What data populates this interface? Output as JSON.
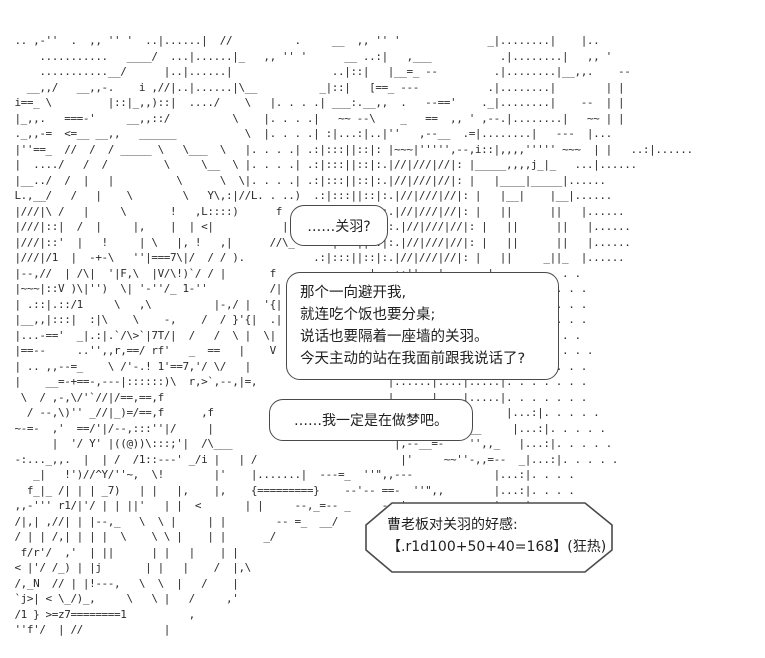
{
  "scene": {
    "background_color": "#ffffff",
    "ink_color": "#2b2b2b",
    "outline_color": "#4a4a4a"
  },
  "bubbles": {
    "guanyu": {
      "text": "……关羽?"
    },
    "monologue": {
      "lines": [
        "那个一向避开我,",
        "就连吃个饭也要分桌;",
        "说话也要隔着一座墙的关羽。",
        "今天主动的站在我面前跟我说话了?"
      ]
    },
    "dream": {
      "text": "……我一定是在做梦吧。"
    },
    "dice": {
      "lines": [
        "曹老板对关羽的好感:",
        "【.r1d100+50+40=168】(狂热)"
      ]
    }
  },
  "ascii_art": {
    "lines": [
      "",
      "",
      "  .. ,-''  .  ,, '' '  ..|......|  //          .     __  ,, '' '              _|........|    |..",
      "      ...........   ____/  ...|......|_   ,, '' '      __ ..:|   ,___           .|........|   ,, '",
      "      ...........__/      |..|......|                ..|::|   |__=_ --         .|........|__,,.    --",
      "    __,,/   __,,-.    i ,//|..|......|\\__          _|::|   [==_ ---           .|........|        | |",
      "  i==_ \\         |::|_,,)::|  ..../    \\   |. . . .| ___:.__,,  .   --=='    ._|........|    --  | |",
      "  |_,,.   ===-'     __,,::/          \\    |. . . .|   ~~ --\\    _   ==  ,, ' ,--.|........|   ~~ | |",
      "  ._,,-=  <=__ __,,   ______           \\  |. . . .| :|...:|..|''   ,--__  .=|........|   ---  |...",
      "  |''==_  //  /  / _____ \\   \\___  \\   |. . . .| .:|:::||::|: |~~~|''''',--,i::|,,,,''''' ~~~  | |   ..:|......",
      "  |  ..../   /  /         \\     \\__  \\ |. . . .| .:|:::||::|:.|//|///|//|: |_____,,,,j_|_   ...|......",
      "  |__../  /  |   |          \\      \\  \\|. . . .| .:|:::||::|:.|//|///|//|: |   |____|_____|......",
      "  L.,__/   /   |    \\        \\   Y\\,:|//L. . ..)  .:|:::||::|:.|//|///|//|: |   |__|    |__|......",
      "  |///|\\ /   |     \\       !   ,L::::)      f     .:|:::||::|:.|//|///|//|: |   ||      ||   |......",
      "  |///|::|  /  |     |,    |  | <|           |     .:|:::||::|:.|//|///|//|: |   ||      ||   |......",
      "  |///|::'  |   !     | \\   |, !   ,|      //\\_    .:|:::||::|:.|//|///|//|: |   ||      ||   |......",
      "  |///|/1  |  -+-\\   ''|===7\\|/  / / ).           .:|:::||::|:.|//|///|//|: |   ||     _||_  |......",
      "  |--,//  | /\\|  '|F,\\  |V/\\!)`/ / |       f               |   ::||   |       |   . . . . . .",
      "  |~~~|::V )\\|'')  \\| '-''/_ 1-''          /|               |   ::||   |       |   . . . . . .",
      "  | .::|.::/1     \\   ,\\          |-,/ |  '{|               |   ::||   |       |   . . . . . .",
      "  |__,,|:::|  :|\\    \\    -,    /  / }'{|  .|               |   ::||   |       |   . . . . . .",
      "  |...-=='  _|.:|.`/\\>`|7T/|  /   /  \\ |  \\|               |   ::||   |       |   . . . . . .",
      "  |==--     ..'',,r,==/ rf'   _  ==   |    V                 \\  ---,|    ---|     . . . . . . .",
      "  | .. ,,--=_    \\ /'-.! 1'==7,'/ \\/   |                      |......|....|.....|. . . . . . .",
      "  |    __=-+==-,---|::::::)\\  r,>`,--,|=,                     |......|....|.....|. . . . . . .",
      "   \\  / ,-,\\/'`//|/==,==,f                                    |......|....|.....|. . . . . . .",
      "    / --,\\)'' _//|_)=/==,f      ,f                            | ..''  ,, --      |...:|. . . . .",
      "  ~-=-  ,'  ==/'|/--,:::''|/     |                             |  .. ,,  --__     |...:|. . . . .",
      "        |  '/ Y' |((@))\\:::;'|  /\\___                          |,--__=-    '',,_   |...:|. . . . .",
      "  -:..._,,.  |  | /  /1::---' _/i |   | /                       |'     ~~''-,,=--  _|...:|. . . . .",
      "     _|   !')//^Y/''~,  \\!        |'    |.......|  ---=_  ''\",,---             |...:|. . . .",
      "    f_|_ /| | | _7)   | |   |,    |,    {=========}    --'-- ==-  ''\",,        |...:|. . . .",
      "  ,,-''' r1/|'/ | | ||'   | |  <       | |     --,_=-- _     ---',-+-=_--   _  |...:|. . . .",
      "  /|,| ,//| | |--,_   \\  \\ |     | |        -- =_  __/                         |...:|. . .",
      "  / | | /,| | | |  \\    \\ \\ |    | |      _/                                   |...:|. . .",
      "   f/r'/  ,'  | ||      | |   |    | |                                         |...:|. .",
      "  < |'/ /_) | |j       | |   |    /  |,\\",
      "  /,_N  // | |!---,   \\  \\  |   /    |",
      "  `j>| < \\_/)_,     \\   \\ |   /     ,'",
      "  /1 } >=z7========1          ,",
      "  ''f'/  | //             |",
      ""
    ]
  }
}
